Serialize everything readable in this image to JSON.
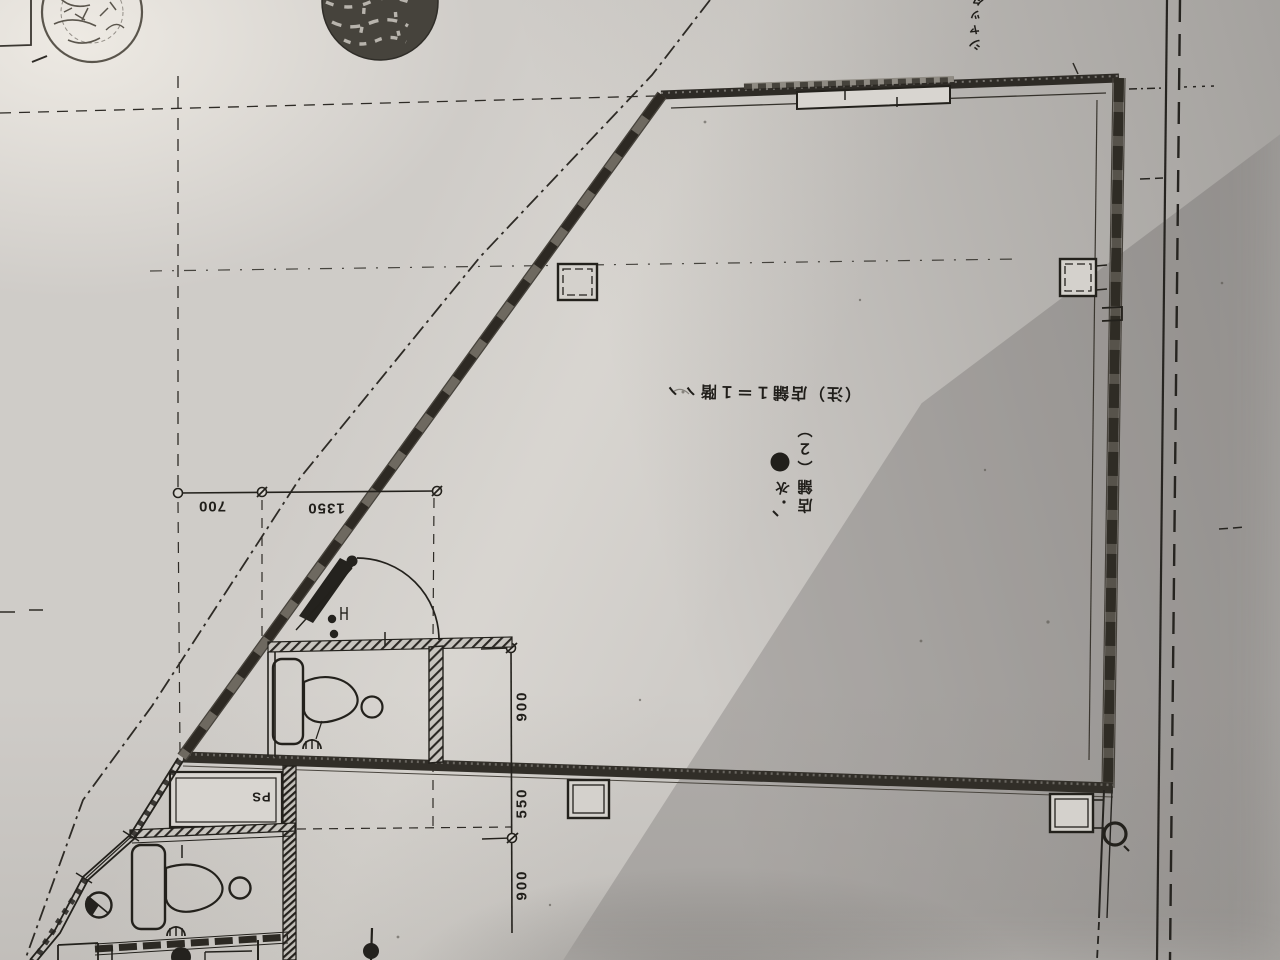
{
  "document": {
    "kind": "architectural floor plan photo, drawing rotated 180 degrees",
    "paper_color": "#cfccc8",
    "ink_color": "#2b2824"
  },
  "annotations": {
    "note_text": "（注）店舗１＝１階ヽヽ",
    "room_label": "店舗（２）",
    "water_label": "水",
    "ps_label": "PS",
    "top_right_label": "シャッター"
  },
  "dimensions": {
    "horizontal": [
      "700",
      "1350"
    ],
    "vertical": [
      "900",
      "550",
      "900"
    ]
  },
  "symbols": {
    "water_point": "filled-circle-water-meter",
    "left_stamp": "circular-stamp-illegible",
    "right_stamp": "dark-seal-stamp-illegible"
  }
}
